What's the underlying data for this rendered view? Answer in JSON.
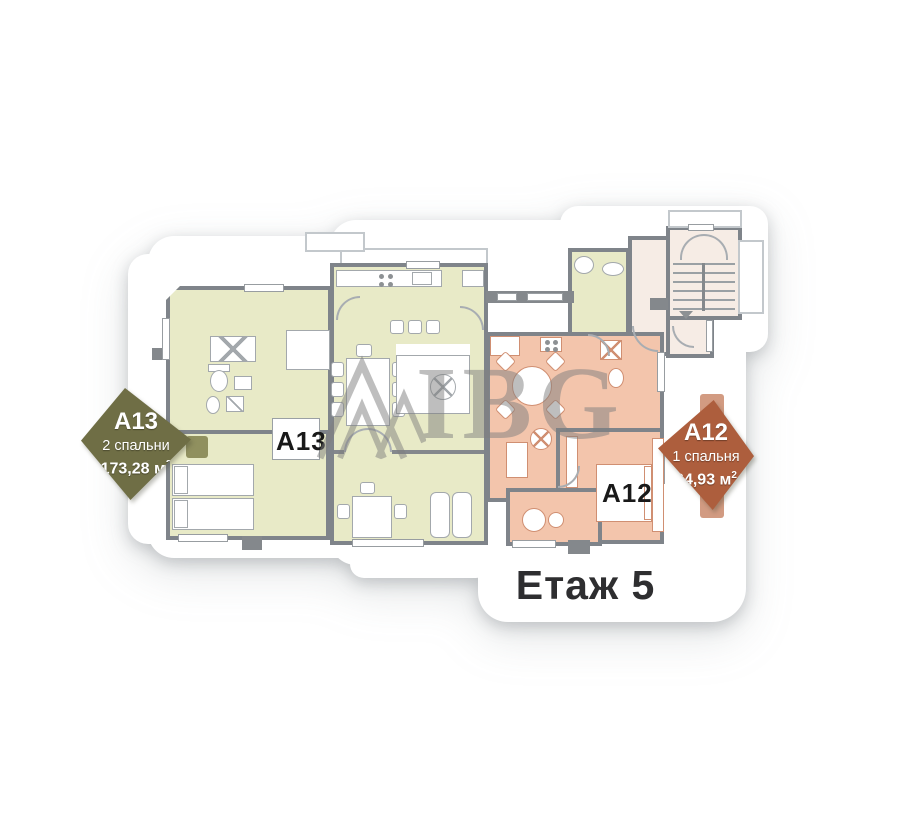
{
  "floor": {
    "label": "Етаж 5"
  },
  "watermark": {
    "text": "IBG"
  },
  "badges": {
    "a13": {
      "unit": "A13",
      "bedrooms": "2 спальни",
      "area_value": "173,28 м",
      "area_sup": "2",
      "color": "#6f6e45"
    },
    "a12": {
      "unit": "A12",
      "bedrooms": "1 спальня",
      "area_value": "64,93 м",
      "area_sup": "2",
      "color": "#ad5e3d"
    }
  },
  "plan": {
    "labels": {
      "a13": "A13",
      "a12": "A12"
    },
    "colors": {
      "a13_fill": "#e8eac7",
      "a12_fill": "#f3c5ac",
      "stairwell_fill": "#f6ece5",
      "wall": "#7f848a",
      "watermark_gray": "#7f7f7f",
      "a12_ribbon": "#d29b82"
    }
  }
}
